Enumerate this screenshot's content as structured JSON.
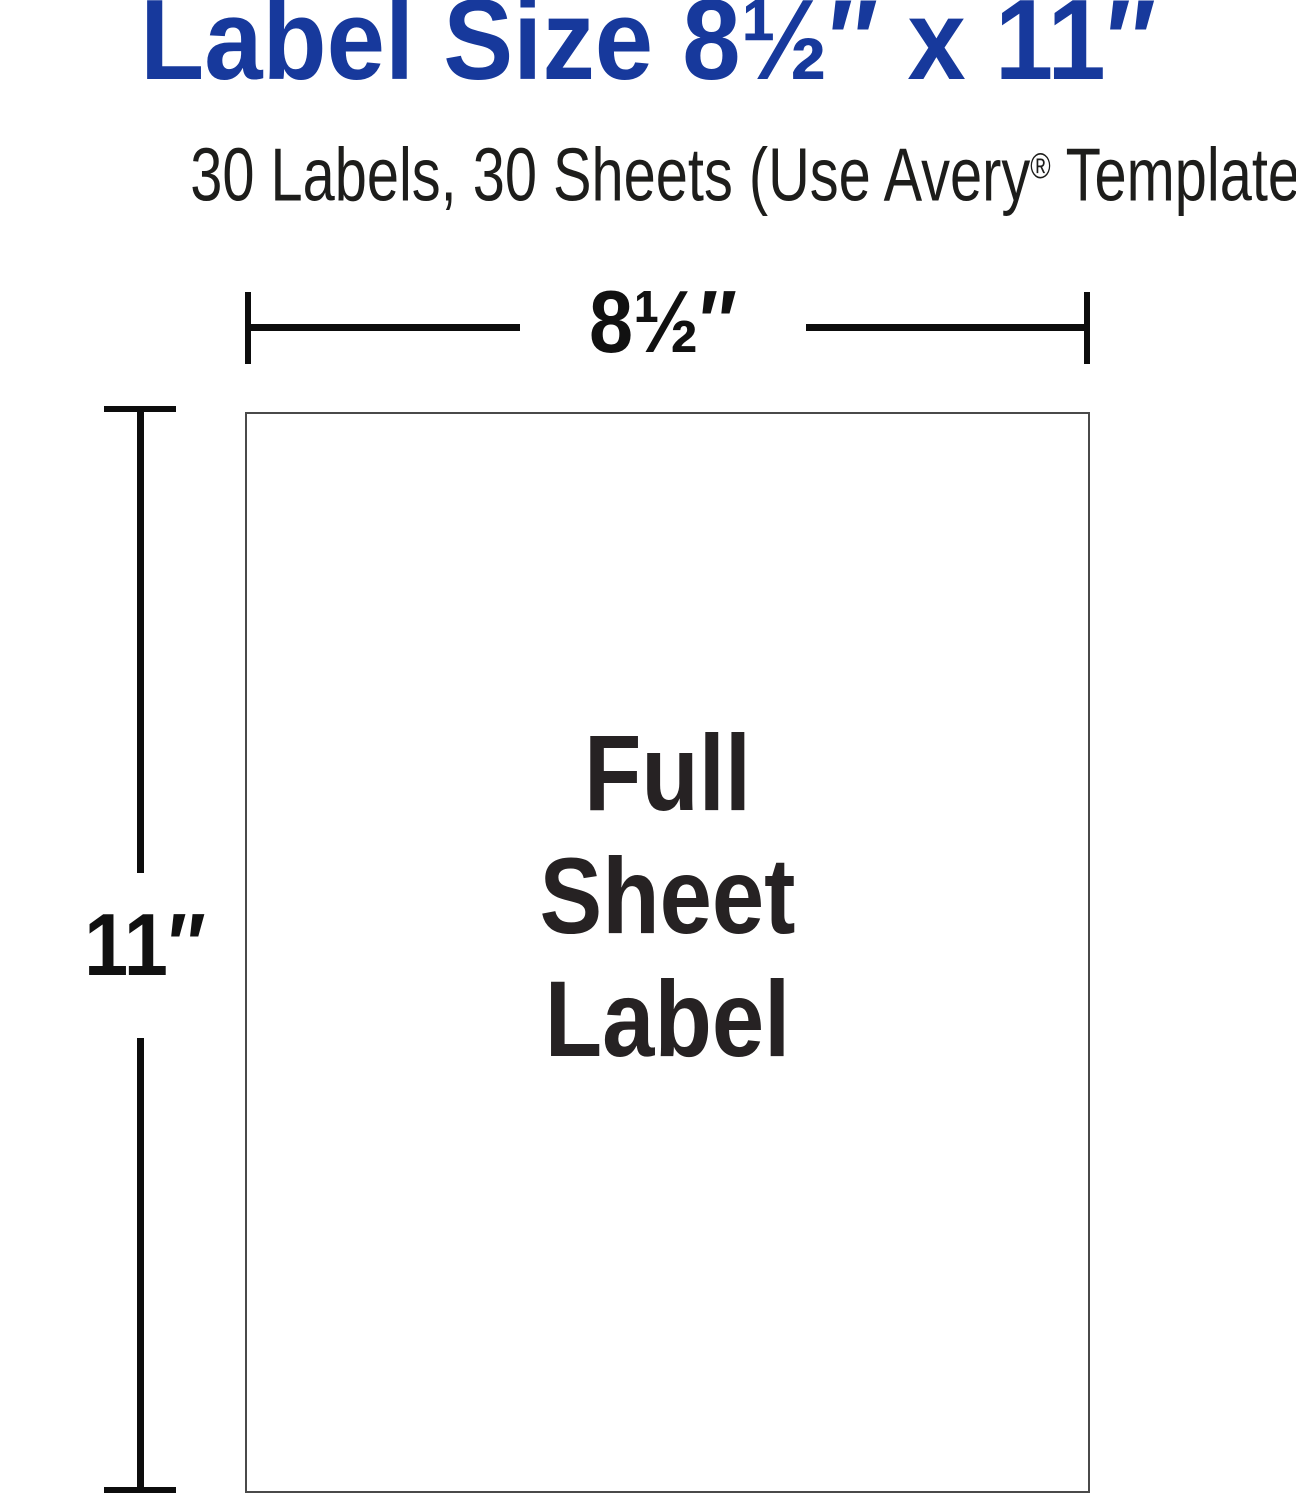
{
  "header": {
    "title": "Label Size 8½″ x 11″",
    "subtitle_prefix": "30 Labels, 30 Sheets (Use Avery",
    "subtitle_reg": "®",
    "subtitle_suffix": " Template 3383)"
  },
  "diagram": {
    "width_label": "8½″",
    "height_label": "11″",
    "sheet_label_lines": [
      "Full",
      "Sheet",
      "Label"
    ]
  },
  "colors": {
    "title_blue": "#17399c",
    "text_dark": "#1d1d1b",
    "dimension_line_black": "#0d0d0d",
    "sheet_border_gray": "#4a4a4a",
    "background": "#ffffff"
  }
}
